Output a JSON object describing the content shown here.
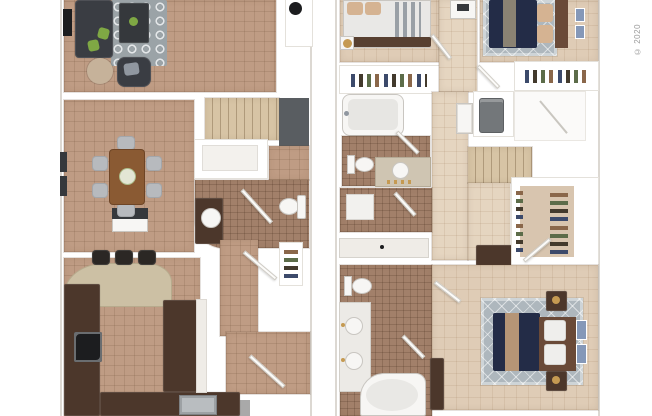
{
  "copyright": "© 2020",
  "palette": {
    "wall": "#ffffff",
    "wall_edge": "#dcd8d2",
    "carpet_tan": "#bf9c84",
    "carpet_beige": "#dfccb6",
    "carpet_beige_light": "#e5d5c0",
    "tile_bath": "#a2806a",
    "cabinet_dark": "#4c372b",
    "counter_granite": "#ccc0a4",
    "counter_white": "#efece7",
    "sofa_dark": "#3a3d43",
    "table_dark": "#35383c",
    "rug_gray": "#9ba3a7",
    "rug_diamond": "#aeb7bd",
    "wood_table": "#8a5a33",
    "chair_gray": "#b7babe",
    "bed_navy": "#232c47",
    "bed_white": "#e9e8e6",
    "pillow_tan": "#d5b392",
    "pillow_gray": "#9097a0",
    "headboard_brown": "#6a4a38",
    "bed_runner": "#8a8273",
    "throw_tan": "#b59576",
    "stairs_beige": "#d7c4a5",
    "accent_wall": "#595d61",
    "appliance_gray": "#73777a",
    "fixture_white": "#f7f6f4",
    "walkin_carpet": "#d8c5af",
    "step_gray": "#a9a9a9",
    "plant_green": "#7fa844",
    "lamp_gold": "#c59a52",
    "black": "#1c1d1f",
    "steel": "#b9bdc0",
    "art_blue": "#8598b8",
    "side_table_tan": "#c6b29a",
    "vanity_top": "#cfc5b2",
    "copyright_gray": "#9a9a9a"
  },
  "floors": [
    {
      "id": "first-floor",
      "position": "left",
      "rooms": [
        {
          "name": "living-room",
          "furniture": [
            "sectional-sofa",
            "armchair",
            "coffee-table",
            "side-table",
            "tv",
            "area-rug"
          ]
        },
        {
          "name": "dining-room",
          "furniture": [
            "dining-table",
            "six-chairs",
            "centerpiece",
            "console",
            "wall-art"
          ]
        },
        {
          "name": "kitchen",
          "furniture": [
            "u-shaped-cabinets",
            "breakfast-bar",
            "three-bar-stools",
            "stove",
            "double-sink"
          ]
        },
        {
          "name": "powder-room",
          "furniture": [
            "vanity-sink",
            "toilet"
          ]
        },
        {
          "name": "pantry",
          "furniture": [
            "shelves"
          ]
        },
        {
          "name": "staircase",
          "furniture": []
        },
        {
          "name": "entry",
          "furniture": [
            "front-door",
            "coat-closet",
            "porch-step",
            "ceiling-light"
          ]
        }
      ]
    },
    {
      "id": "second-floor",
      "position": "right",
      "rooms": [
        {
          "name": "bedroom-2",
          "furniture": [
            "bed",
            "nightstand-lamp",
            "closet"
          ]
        },
        {
          "name": "bedroom-3",
          "furniture": [
            "bed",
            "area-rug",
            "wall-art",
            "closet"
          ]
        },
        {
          "name": "bathroom-2",
          "furniture": [
            "bathtub",
            "toilet",
            "vanity-sink"
          ]
        },
        {
          "name": "utility-closet",
          "furniture": [
            "water-heater"
          ]
        },
        {
          "name": "laundry-room",
          "furniture": [
            "appliance-pad"
          ]
        },
        {
          "name": "walk-in-closet",
          "furniture": [
            "clothes-racks"
          ]
        },
        {
          "name": "master-bathroom",
          "furniture": [
            "double-vanity",
            "toilet",
            "garden-tub"
          ]
        },
        {
          "name": "master-bedroom",
          "furniture": [
            "bed",
            "two-nightstands",
            "dresser",
            "area-rug",
            "wall-art"
          ]
        },
        {
          "name": "staircase",
          "furniture": []
        },
        {
          "name": "hallway",
          "furniture": [
            "linen-cabinet",
            "hall-cabinet",
            "dresser"
          ]
        }
      ]
    }
  ]
}
